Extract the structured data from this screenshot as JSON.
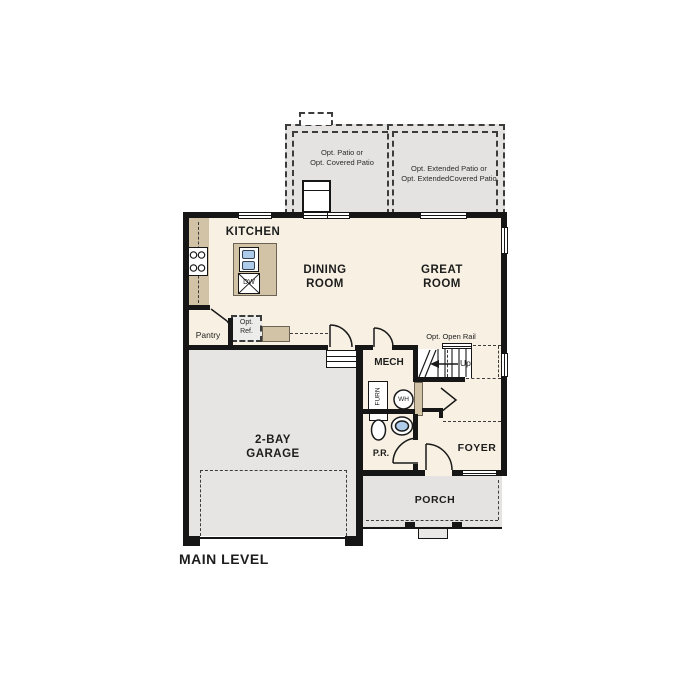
{
  "title": {
    "main_level": "MAIN LEVEL"
  },
  "rooms": {
    "kitchen": "KITCHEN",
    "dining1": "DINING",
    "dining2": "ROOM",
    "great1": "GREAT",
    "great2": "ROOM",
    "garage1": "2-BAY",
    "garage2": "GARAGE",
    "mech": "MECH",
    "pr": "P.R.",
    "foyer": "FOYER",
    "porch": "PORCH",
    "pantry": "Pantry"
  },
  "options": {
    "patio_left1": "Opt. Patio or",
    "patio_left2": "Opt. Covered Patio",
    "patio_right1": "Opt. Extended Patio or",
    "patio_right2": "Opt. ExtendedCovered Patio",
    "open_rail": "Opt. Open Rail",
    "ref1": "Opt.",
    "ref2": "Ref.",
    "up": "Up"
  },
  "fixtures": {
    "dw": "DW",
    "furn": "FURN",
    "wh": "WH"
  },
  "colors": {
    "floor": "#f8f1e3",
    "patio_gray": "#e4e3e1",
    "counter_tan": "#d2c3a7",
    "wall_black": "#161616",
    "fixture_blue": "#aecce9"
  }
}
